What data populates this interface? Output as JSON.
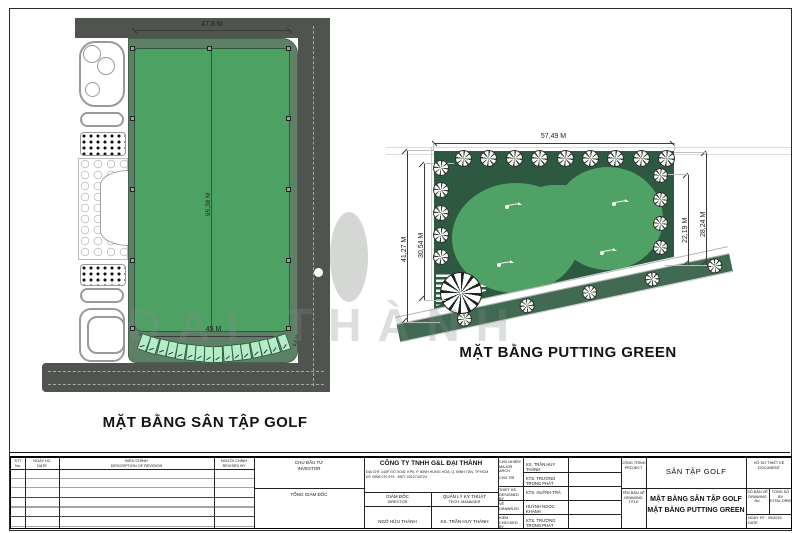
{
  "watermark": "ĐẠI THÀNH",
  "left_plan": {
    "title": "MẶT BẰNG SÂN TẬP GOLF",
    "dim_top": "47,8 M",
    "dim_height": "95,38 M",
    "dim_bottom": "45 M",
    "dim_tee": "5,6 M",
    "tee_count": 16
  },
  "right_plan": {
    "title": "MẶT BẰNG PUTTING GREEN",
    "dim_top": "57,49 M",
    "dim_left_outer": "41,27 M",
    "dim_left_inner": "30,54 M",
    "dim_right_inner": "22,19 M",
    "dim_right_outer": "28,24 M",
    "trees_top": 9,
    "trees_left": 5,
    "trees_right": 4,
    "trees_diag": 5
  },
  "colors": {
    "field_green": "#4da163",
    "buffer_green": "#5d8066",
    "putting_dark_green": "#2e5941",
    "road_gray": "#50544f",
    "tee_mint": "#b4ecca",
    "diag_road_green": "#426a52"
  },
  "title_block": {
    "revision": {
      "no_vn": "STT",
      "no_en": "No.",
      "date_vn": "NGÀY HC",
      "date_en": "DATE",
      "desc_vn": "ĐIỀU CHỈNH",
      "desc_en": "DESCRIPTION OF REVISION",
      "by_vn": "NGƯỜI CHỈNH",
      "by_en": "REVISED BY"
    },
    "investor": {
      "label_vn": "CHỦ ĐẦU TƯ",
      "label_en": "INVESTOR",
      "signer": "TỔNG GIÁM ĐỐC"
    },
    "company": {
      "name": "CÔNG TY TNHH G&L ĐẠI THÀNH",
      "address": "ĐỊA CHỈ: 140F GÒ XOÀI, KP6, P. BÌNH HƯNG HÒA, Q. BÌNH TÂN, TP.HCM",
      "phone": "ĐT: 0908 070 979 - MST: 0312734724"
    },
    "director": {
      "label_vn": "GIÁM ĐỐC",
      "label_en": "DIRECTOR",
      "name": "NGÔ HỮU THÀNH"
    },
    "tech": {
      "label_vn": "QUẢN LÝ KỸ THUẬT",
      "label_en": "TECH. MANAGER",
      "name": "KS. TRẦN HUY THÀNH"
    },
    "roles": {
      "chunhiem_vn": "CHỦ NHIỆM",
      "chunhiem_en": "MAJOR ARCH.",
      "chunhiem_name": "KS. TRẦN HUY THÀNH",
      "chutri_vn": "CHỦ TRÌ",
      "chutri_name": "KTS. TRƯƠNG TRỌNG PHÁT",
      "thietke_vn": "THIẾT KẾ",
      "thietke_en": "DESIGNED BY",
      "thietke_name": "KTS. HUỲNH TRÀ",
      "ve_vn": "VẼ",
      "ve_en": "DRAWN BY",
      "ve_name": "HUỲNH NGỌC KHANH",
      "kiem_vn": "KIỂM",
      "kiem_en": "CHECKED BY",
      "kiem_name": "KTS. TRƯƠNG TRỌNG PHÁT"
    },
    "project": {
      "label_vn": "CÔNG TRÌNH",
      "label_en": "PROJECT",
      "name": "SÂN TẬP GOLF"
    },
    "drawing": {
      "label_vn": "TÊN BẢN VẼ",
      "label_en": "DRAWING TITLE",
      "line1": "MẶT BẰNG SÂN TẬP GOLF",
      "line2": "MẶT BẰNG PUTTING GREEN"
    },
    "doc": {
      "label_vn": "HỒ SƠ THIẾT KẾ",
      "label_en": "DOCUMENT",
      "sheet_no_vn": "SỐ BẢN VẼ",
      "sheet_no_en": "DRAWING No.",
      "total_vn": "TỔNG SỐ BV",
      "total_en": "TOTAL DRW.",
      "date_line": "NGÀY HT : 09/2015",
      "date_en": "DATE"
    }
  }
}
